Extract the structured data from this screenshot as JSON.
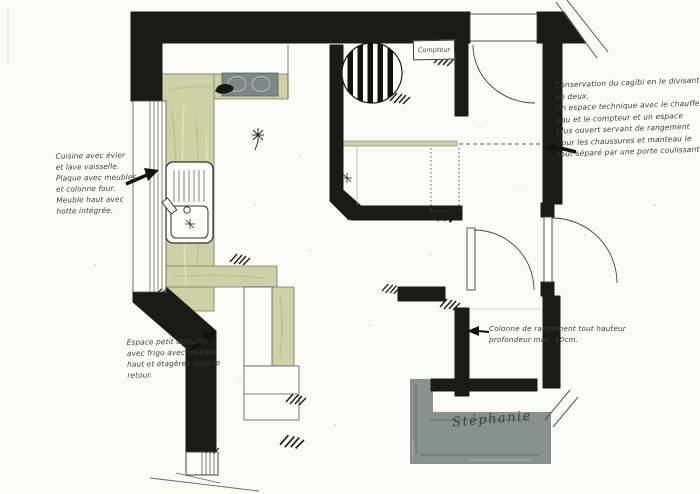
{
  "plan": {
    "compteur_label": "Compteur",
    "signature": "Stéphanie"
  },
  "annotations": {
    "kitchen": {
      "lines": [
        "Cuisine avec évier",
        "et lave vaisselle.",
        "Plaque avec meubles",
        "et colonne four.",
        "Meuble haut avec",
        "hotte intégrée."
      ]
    },
    "breakfast": {
      "lines": [
        "Espace petit déjeuner",
        "avec frigo avec meuble",
        "haut et étagères dans le",
        "retour."
      ]
    },
    "cagibi": {
      "lines": [
        "Conservation du cagibi en le divisant",
        "en deux.",
        "Un espace technique avec le chauffe",
        "eau et le compteur et un espace",
        "plus ouvert servant de rangement",
        "pour les chaussures et manteau le",
        "tout séparé par une porte coulissante."
      ]
    },
    "storage_column": {
      "lines": [
        "Colonne de rangement tout hauteur",
        "profondeur max. 50cm."
      ]
    }
  },
  "colors": {
    "wall_black": "#1a1a17",
    "counter_green": "#cdd1a5",
    "hob_gray": "#7d8787",
    "terrace_gray": "#87918d",
    "paper": "#fafaf7",
    "ink": "#3b3b44"
  },
  "symbols": [
    "striped-circle-icon",
    "door-swing-arc-icon",
    "window-hatch-icon",
    "sink-icon",
    "hob-icon",
    "break-line-icon",
    "hatch-mark-icon",
    "annotation-arrow-icon"
  ]
}
